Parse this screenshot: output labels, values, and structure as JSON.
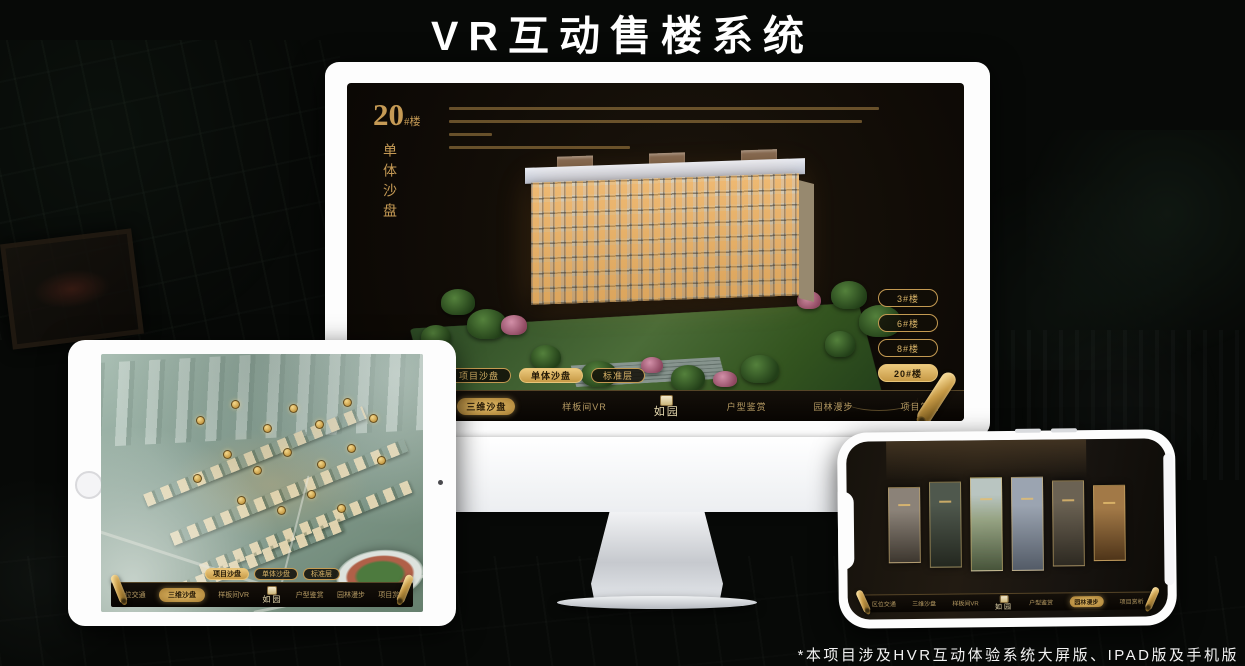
{
  "page": {
    "title": "VR互动售楼系统",
    "footnote": "*本项目涉及HVR互动体验系统大屏版、IPAD版及手机版"
  },
  "colors": {
    "gold": "#c79a4e",
    "gold_bright": "#e8c478",
    "screen_bg": "#151009",
    "device_body": "#fdfdfd"
  },
  "desktop_app": {
    "building_title": {
      "number": "20",
      "unit": "#楼",
      "subtitle": "单体沙盘"
    },
    "floor_buttons": [
      {
        "label": "3#楼",
        "active": false
      },
      {
        "label": "6#楼",
        "active": false
      },
      {
        "label": "8#楼",
        "active": false
      },
      {
        "label": "20#楼",
        "active": true
      }
    ],
    "view_tabs": [
      {
        "label": "项目沙盘",
        "active": false
      },
      {
        "label": "单体沙盘",
        "active": true
      },
      {
        "label": "标准层",
        "active": false
      }
    ],
    "nav": {
      "logo": "如园",
      "items": [
        {
          "label": "区位交通",
          "active": false
        },
        {
          "label": "三维沙盘",
          "active": true
        },
        {
          "label": "样板间VR",
          "active": false
        },
        {
          "label": "户型鉴赏",
          "active": false
        },
        {
          "label": "园林漫步",
          "active": false
        },
        {
          "label": "项目赏析",
          "active": false
        }
      ]
    }
  },
  "ipad_app": {
    "view_tabs": [
      {
        "label": "项目沙盘",
        "active": true
      },
      {
        "label": "单体沙盘",
        "active": false
      },
      {
        "label": "标准层",
        "active": false
      }
    ],
    "nav": {
      "logo": "如园",
      "items": [
        {
          "label": "区位交通",
          "active": false
        },
        {
          "label": "三维沙盘",
          "active": true
        },
        {
          "label": "样板间VR",
          "active": false
        },
        {
          "label": "户型鉴赏",
          "active": false
        },
        {
          "label": "园林漫步",
          "active": false
        },
        {
          "label": "项目赏析",
          "active": false
        }
      ]
    }
  },
  "phone_app": {
    "nav": {
      "logo": "如园",
      "items": [
        {
          "label": "区位交通",
          "active": false
        },
        {
          "label": "三维沙盘",
          "active": false
        },
        {
          "label": "样板间VR",
          "active": false
        },
        {
          "label": "户型鉴赏",
          "active": false
        },
        {
          "label": "园林漫步",
          "active": true
        },
        {
          "label": "项目赏析",
          "active": false
        }
      ]
    }
  }
}
